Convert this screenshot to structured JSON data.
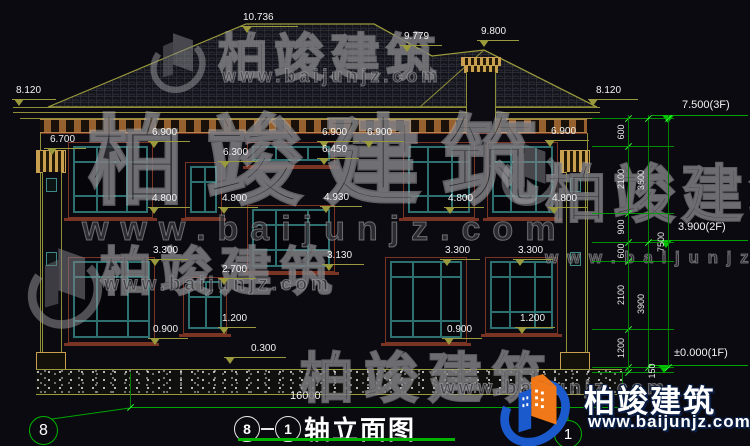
{
  "drawing": {
    "type": "architectural-elevation",
    "title": {
      "axis_start": "8",
      "axis_end": "1",
      "name": "轴立面图"
    },
    "bottom_dimension_total": "16000",
    "axis_bubbles": {
      "left": "8",
      "right": "1"
    },
    "level_markers_right": [
      {
        "t": "7.500(3F)",
        "x": 682,
        "y": 99,
        "lx": 652,
        "lw": 96,
        "ly": 115,
        "ax": 668
      },
      {
        "t": "3.900(2F)",
        "x": 678,
        "y": 221,
        "lx": 650,
        "lw": 98,
        "ly": 240,
        "ax": 666
      },
      {
        "t": "±0.000(1F)",
        "x": 674,
        "y": 347,
        "lx": 648,
        "lw": 100,
        "ly": 365,
        "ax": 664
      }
    ],
    "facade_markers": [
      {
        "t": "10.736",
        "x": 243,
        "y": 12,
        "lx": 240,
        "lw": 58,
        "ly": 26,
        "ax": 247
      },
      {
        "t": "9.779",
        "x": 404,
        "y": 31,
        "lx": 400,
        "lw": 42,
        "ly": 45,
        "ax": 407
      },
      {
        "t": "9.800",
        "x": 481,
        "y": 26,
        "lx": 477,
        "lw": 42,
        "ly": 40,
        "ax": 484
      },
      {
        "t": "8.120",
        "x": 16,
        "y": 85,
        "lx": 12,
        "lw": 44,
        "ly": 99,
        "ax": 19
      },
      {
        "t": "8.120",
        "x": 596,
        "y": 85,
        "lx": 588,
        "lw": 50,
        "ly": 99,
        "ax": 593
      },
      {
        "t": "6.700",
        "x": 50,
        "y": 134,
        "lx": 44,
        "lw": 42,
        "ly": 148,
        "ax": 52
      },
      {
        "t": "6.900",
        "x": 152,
        "y": 127,
        "lx": 148,
        "lw": 42,
        "ly": 141,
        "ax": 154
      },
      {
        "t": "6.300",
        "x": 223,
        "y": 147,
        "lx": 218,
        "lw": 40,
        "ly": 161,
        "ax": 225
      },
      {
        "t": "6.900",
        "x": 322,
        "y": 127,
        "lx": 317,
        "lw": 42,
        "ly": 141,
        "ax": 324
      },
      {
        "t": "6.450",
        "x": 322,
        "y": 144,
        "lx": 317,
        "lw": 42,
        "ly": 158,
        "ax": 324
      },
      {
        "t": "6.900",
        "x": 367,
        "y": 127,
        "lx": 362,
        "lw": 42,
        "ly": 141,
        "ax": 369
      },
      {
        "t": "6.900",
        "x": 551,
        "y": 126,
        "lx": 545,
        "lw": 44,
        "ly": 140,
        "ax": 550
      },
      {
        "t": "4.800",
        "x": 152,
        "y": 193,
        "lx": 148,
        "lw": 42,
        "ly": 207,
        "ax": 154
      },
      {
        "t": "4.800",
        "x": 222,
        "y": 193,
        "lx": 218,
        "lw": 40,
        "ly": 207,
        "ax": 224
      },
      {
        "t": "4.930",
        "x": 324,
        "y": 192,
        "lx": 320,
        "lw": 42,
        "ly": 206,
        "ax": 326
      },
      {
        "t": "4.800",
        "x": 448,
        "y": 193,
        "lx": 444,
        "lw": 40,
        "ly": 207,
        "ax": 450
      },
      {
        "t": "4.800",
        "x": 552,
        "y": 193,
        "lx": 548,
        "lw": 40,
        "ly": 207,
        "ax": 554
      },
      {
        "t": "3.300",
        "x": 153,
        "y": 245,
        "lx": 148,
        "lw": 40,
        "ly": 259,
        "ax": 155
      },
      {
        "t": "3.130",
        "x": 327,
        "y": 250,
        "lx": 322,
        "lw": 42,
        "ly": 264,
        "ax": 329
      },
      {
        "t": "3.300",
        "x": 445,
        "y": 245,
        "lx": 440,
        "lw": 40,
        "ly": 259,
        "ax": 447
      },
      {
        "t": "3.300",
        "x": 518,
        "y": 245,
        "lx": 513,
        "lw": 40,
        "ly": 259,
        "ax": 520
      },
      {
        "t": "2.700",
        "x": 222,
        "y": 264,
        "lx": 218,
        "lw": 38,
        "ly": 278,
        "ax": 224
      },
      {
        "t": "1.200",
        "x": 222,
        "y": 313,
        "lx": 218,
        "lw": 38,
        "ly": 327,
        "ax": 224
      },
      {
        "t": "0.900",
        "x": 153,
        "y": 324,
        "lx": 148,
        "lw": 40,
        "ly": 338,
        "ax": 155
      },
      {
        "t": "0.900",
        "x": 447,
        "y": 324,
        "lx": 442,
        "lw": 40,
        "ly": 338,
        "ax": 449
      },
      {
        "t": "1.200",
        "x": 520,
        "y": 313,
        "lx": 515,
        "lw": 40,
        "ly": 327,
        "ax": 522
      },
      {
        "t": "0.300",
        "x": 251,
        "y": 343,
        "lx": 224,
        "lw": 62,
        "ly": 357,
        "ax": 230
      }
    ],
    "dim_chain": {
      "tick_levels": [
        118,
        146,
        213,
        242,
        261,
        329,
        367,
        372
      ],
      "verticals": [
        628,
        648,
        668
      ],
      "inner_labels": [
        {
          "t": "600",
          "x": 621,
          "y": 132
        },
        {
          "t": "2100",
          "x": 621,
          "y": 179
        },
        {
          "t": "900",
          "x": 621,
          "y": 227
        },
        {
          "t": "600",
          "x": 621,
          "y": 251
        },
        {
          "t": "2100",
          "x": 621,
          "y": 295
        },
        {
          "t": "1200",
          "x": 621,
          "y": 348
        }
      ],
      "mid_labels": [
        {
          "t": "3600",
          "x": 641,
          "y": 180
        },
        {
          "t": "3900",
          "x": 641,
          "y": 304
        }
      ],
      "outer_labels": [
        {
          "t": "7500",
          "x": 661,
          "y": 242
        }
      ],
      "extra_labels": [
        {
          "t": "150",
          "x": 652,
          "y": 371
        }
      ]
    },
    "windows": [
      {
        "x": 73,
        "y": 146,
        "w": 75,
        "h": 67
      },
      {
        "x": 190,
        "y": 166,
        "w": 27,
        "h": 47
      },
      {
        "x": 252,
        "y": 146,
        "w": 78,
        "h": 15
      },
      {
        "x": 408,
        "y": 146,
        "w": 62,
        "h": 67
      },
      {
        "x": 492,
        "y": 146,
        "w": 61,
        "h": 67
      },
      {
        "x": 252,
        "y": 209,
        "w": 78,
        "h": 58
      },
      {
        "x": 188,
        "y": 281,
        "w": 34,
        "h": 48
      },
      {
        "x": 73,
        "y": 261,
        "w": 77,
        "h": 77
      },
      {
        "x": 390,
        "y": 261,
        "w": 72,
        "h": 77
      },
      {
        "x": 490,
        "y": 261,
        "w": 63,
        "h": 68
      }
    ]
  },
  "watermark": {
    "brand": "柏竣建筑",
    "url": "www.baijunjz.com",
    "url_spaced": "w w w . b a i j u n j z . c o m"
  },
  "brand_logo": {
    "name": "柏竣建筑",
    "url": "www.baijunjz.com",
    "blue": "#1a5acc",
    "orange": "#f07818"
  }
}
